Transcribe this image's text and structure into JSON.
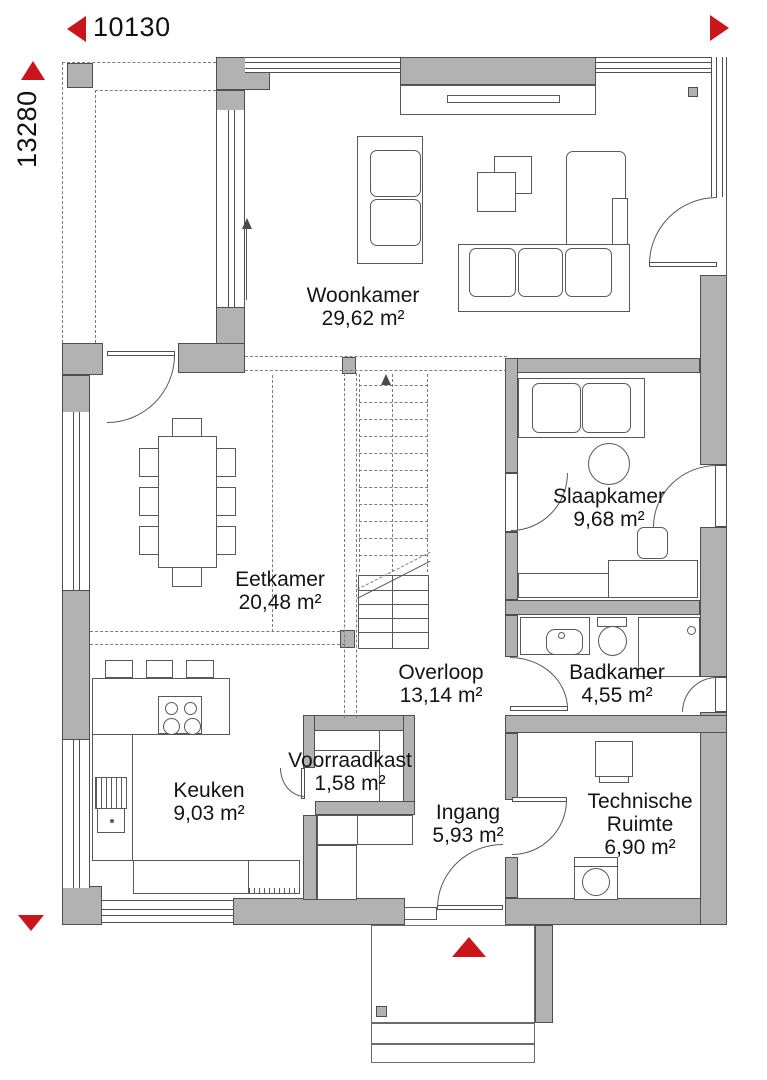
{
  "meta": {
    "type": "floorplan-ground-floor",
    "language": "nl"
  },
  "dimensions": {
    "width_label": "10130",
    "height_label": "13280"
  },
  "rooms": [
    {
      "name": "Woonkamer",
      "area": "29,62 m²"
    },
    {
      "name": "Eetkamer",
      "area": "20,48 m²"
    },
    {
      "name": "Slaapkamer",
      "area": "9,68 m²"
    },
    {
      "name": "Overloop",
      "area": "13,14 m²"
    },
    {
      "name": "Badkamer",
      "area": "4,55 m²"
    },
    {
      "name": "Voorraadkast",
      "area": "1,58 m²"
    },
    {
      "name": "Keuken",
      "area": "9,03 m²"
    },
    {
      "name": "Ingang",
      "area": "5,93 m²"
    },
    {
      "name": "Technische Ruimte",
      "area": "6,90 m²"
    }
  ],
  "markers": {
    "width_arrow": "left-arrow",
    "height_arrow": "up-arrow",
    "top_right_arrow": "right-arrow",
    "bottom_left_arrow": "down-arrow",
    "entrance_marker": "up-triangle"
  },
  "colors": {
    "wall": "#b2b2b2",
    "outline": "#4f4f4f",
    "accent_red": "#c9151b",
    "background": "#ffffff"
  }
}
